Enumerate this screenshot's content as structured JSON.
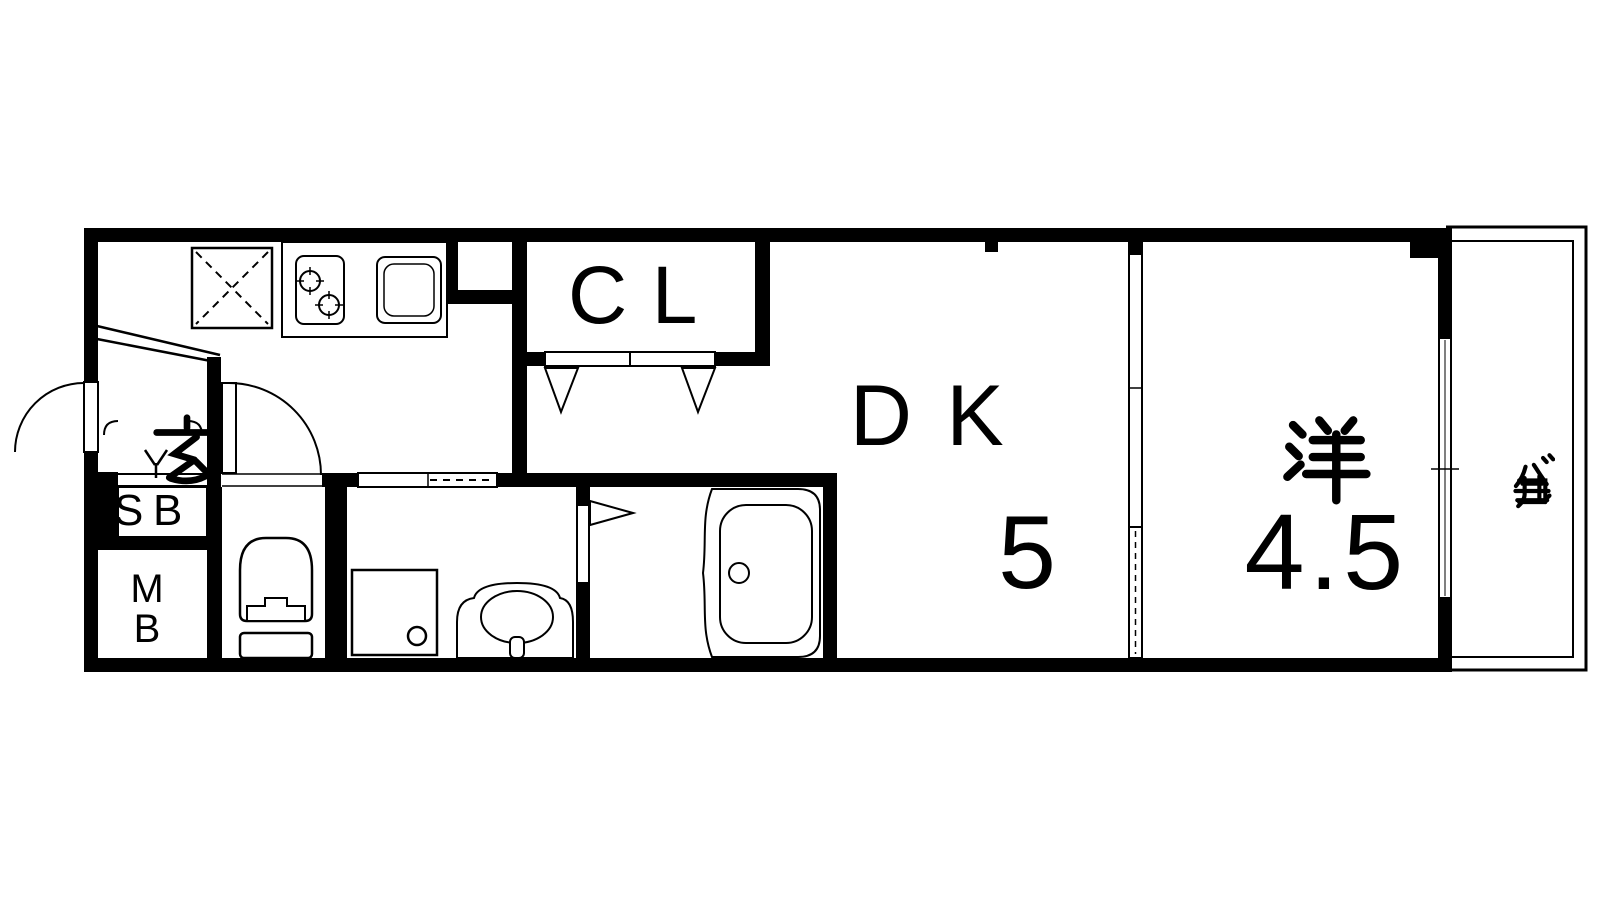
{
  "plan": {
    "background_color": "#ffffff",
    "line_color": "#000000",
    "rooms": {
      "entrance": {
        "label": "玄"
      },
      "shoe_box": {
        "label": "SB"
      },
      "meter_box": {
        "label": "MB"
      },
      "closet": {
        "label": "CL"
      },
      "dining_kitchen": {
        "label": "DK",
        "size": "5"
      },
      "western_room": {
        "label": "洋",
        "size": "4.5"
      },
      "balcony": {
        "label": "バルコニー"
      }
    },
    "fixtures": [
      "refrigerator-space",
      "gas-stove",
      "kitchen-sink",
      "closet-folding-doors",
      "entrance-door",
      "toilet",
      "toilet-door",
      "washroom-sliding-door",
      "washing-machine-pan",
      "wash-basin",
      "bathroom-folding-door",
      "bathtub",
      "room-sliding-partition",
      "balcony-window"
    ]
  }
}
